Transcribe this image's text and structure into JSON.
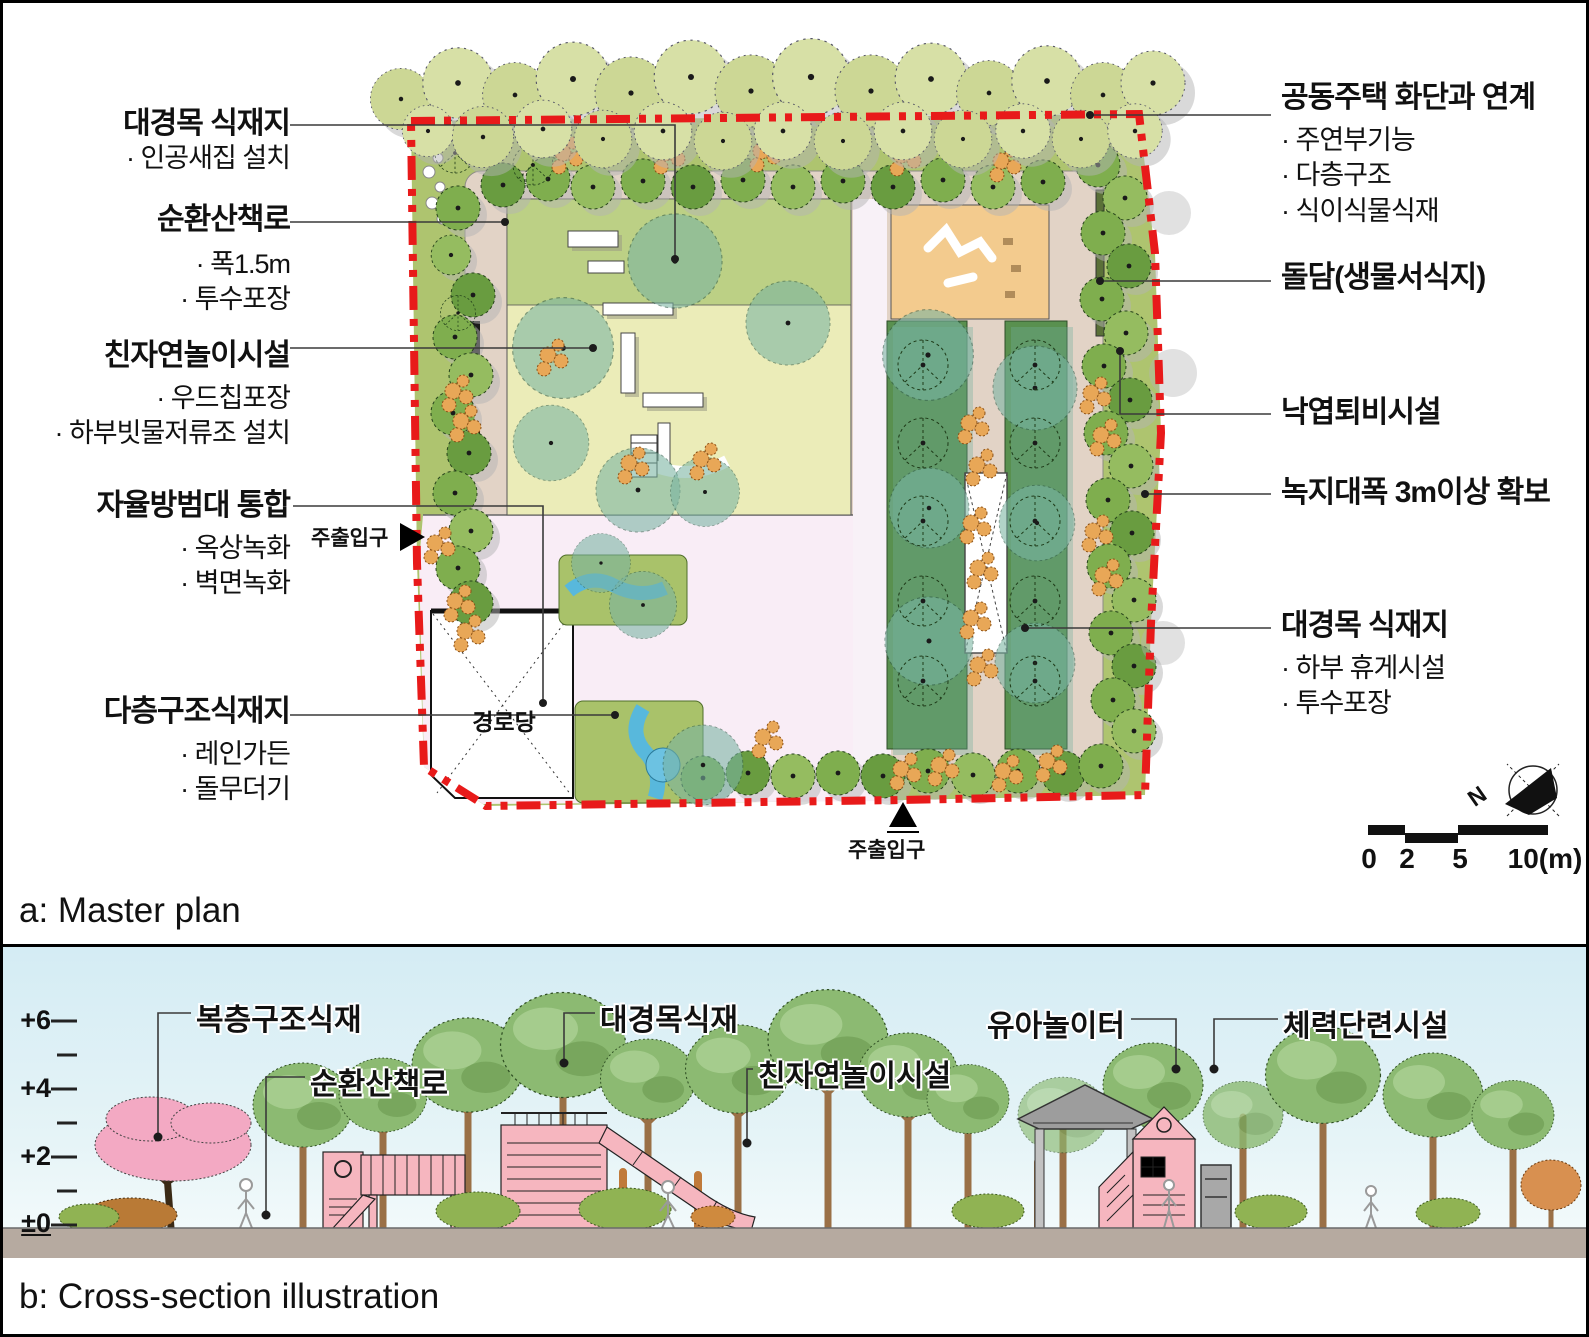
{
  "page": {
    "panel_a_caption": "a: Master plan",
    "panel_b_caption": "b: Cross-section illustration"
  },
  "master_plan": {
    "left_labels": [
      {
        "title": "대경목 식재지",
        "items": [
          "인공새집 설치"
        ]
      },
      {
        "title": "순환산책로",
        "items": [
          "폭1.5m",
          "투수포장"
        ]
      },
      {
        "title": "친자연놀이시설",
        "items": [
          "우드칩포장",
          "하부빗물저류조 설치"
        ]
      },
      {
        "title": "자율방범대 통합",
        "items": [
          "옥상녹화",
          "벽면녹화"
        ]
      },
      {
        "title": "다층구조식재지",
        "items": [
          "레인가든",
          "돌무더기"
        ]
      }
    ],
    "right_labels": [
      {
        "title": "공동주택 화단과 연계",
        "items": [
          "주연부기능",
          "다층구조",
          "식이식물식재"
        ]
      },
      {
        "title": "돌담(생물서식지)",
        "items": []
      },
      {
        "title": "낙엽퇴비시설",
        "items": []
      },
      {
        "title": "녹지대폭 3m이상 확보",
        "items": []
      },
      {
        "title": "대경목 식재지",
        "items": [
          "하부 휴게시설",
          "투수포장"
        ]
      }
    ],
    "entrance_left": "주출입구",
    "entrance_bottom": "주출입구",
    "building_label": "경로당",
    "compass_n": "N",
    "scale_labels": [
      "0",
      "2",
      "5",
      "10(m)"
    ]
  },
  "cross_section": {
    "labels": [
      "복층구조식재",
      "순환산책로",
      "대경목식재",
      "친자연놀이시설",
      "유아놀이터",
      "체력단련시설"
    ],
    "elevation_marks": [
      "+6",
      "+4",
      "+2",
      "±0"
    ]
  },
  "colors": {
    "boundary_red": "#e81a1a",
    "tree_green": "#7fae4e",
    "teal_tree": "#79b4a2",
    "path_tan": "#e2d3c6",
    "plaza_pink": "#f9edf6",
    "sand_orange": "#f3cb8e",
    "equip_pink": "#f6b6bf",
    "sky_blue": "#d6edf4",
    "ground": "#b6aaa0"
  }
}
